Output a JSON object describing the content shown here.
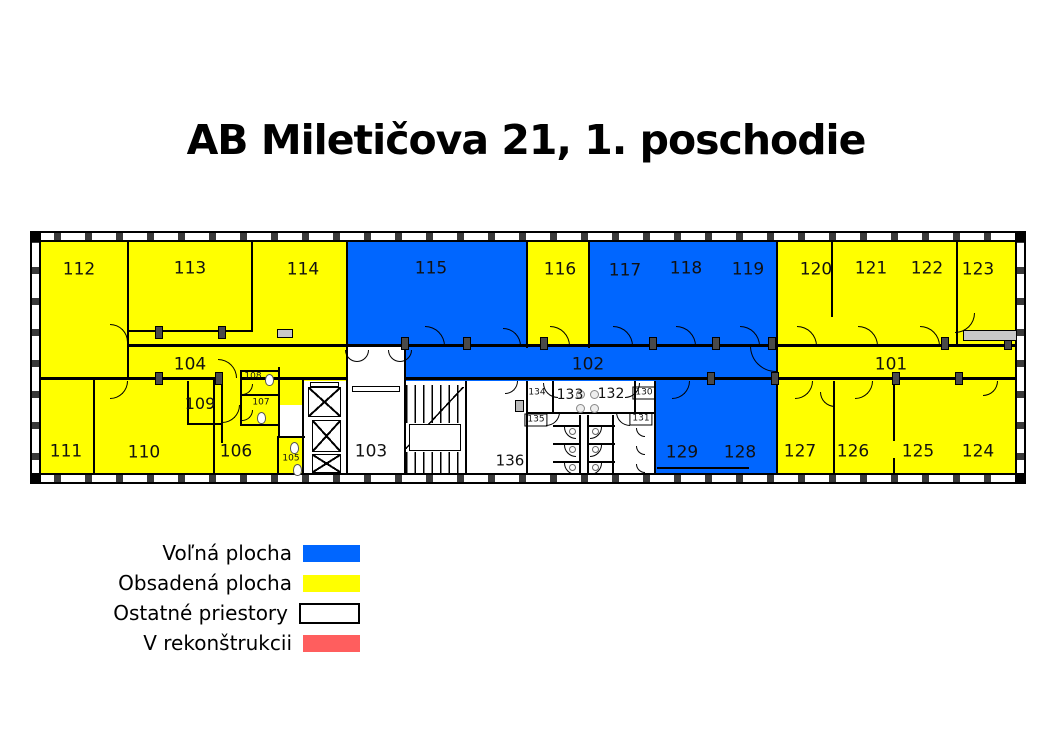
{
  "title": "AB Miletičova 21, 1. poschodie",
  "colors": {
    "free": "#0066FF",
    "occupied": "#FFFF00",
    "other": "#FFFFFF",
    "reconstruction": "#FF5E5E",
    "wall": "#000000",
    "text": "#111111"
  },
  "legend": {
    "items": [
      {
        "label": "Voľná plocha",
        "key": "free"
      },
      {
        "label": "Obsadená plocha",
        "key": "occupied"
      },
      {
        "label": "Ostatné priestory",
        "key": "other"
      },
      {
        "label": "V rekonštrukcii",
        "key": "reconstruction"
      }
    ]
  },
  "plan": {
    "outer": {
      "x": 30,
      "y": 231,
      "w": 996,
      "h": 253,
      "t": 11
    },
    "regions": [
      {
        "name": "block-left-occupied",
        "fill": "occupied",
        "x": 41,
        "y": 242,
        "w": 307,
        "h": 231
      },
      {
        "name": "room-115",
        "fill": "free",
        "x": 348,
        "y": 242,
        "w": 179,
        "h": 104
      },
      {
        "name": "room-116",
        "fill": "occupied",
        "x": 527,
        "y": 242,
        "w": 63,
        "h": 104
      },
      {
        "name": "rooms-117-119",
        "fill": "free",
        "x": 590,
        "y": 242,
        "w": 187,
        "h": 104
      },
      {
        "name": "rooms-120-123",
        "fill": "occupied",
        "x": 777,
        "y": 242,
        "w": 238,
        "h": 104
      },
      {
        "name": "corridor-102",
        "fill": "free",
        "x": 405,
        "y": 346,
        "w": 372,
        "h": 35
      },
      {
        "name": "corridor-101",
        "fill": "occupied",
        "x": 777,
        "y": 346,
        "w": 238,
        "h": 35
      },
      {
        "name": "lobby-103",
        "fill": "other",
        "x": 348,
        "y": 346,
        "w": 57,
        "h": 127
      },
      {
        "name": "elevator-area",
        "fill": "other",
        "x": 303,
        "y": 381,
        "w": 45,
        "h": 92
      },
      {
        "name": "vestibule-105",
        "fill": "other",
        "x": 278,
        "y": 405,
        "w": 25,
        "h": 31
      },
      {
        "name": "stairs-area",
        "fill": "other",
        "x": 405,
        "y": 381,
        "w": 61,
        "h": 92
      },
      {
        "name": "room-136",
        "fill": "other",
        "x": 466,
        "y": 381,
        "w": 61,
        "h": 92
      },
      {
        "name": "toilet-block",
        "fill": "other",
        "x": 527,
        "y": 381,
        "w": 128,
        "h": 92
      },
      {
        "name": "rooms-128-129",
        "fill": "free",
        "x": 655,
        "y": 381,
        "w": 122,
        "h": 92
      },
      {
        "name": "rooms-124-127",
        "fill": "occupied",
        "x": 777,
        "y": 381,
        "w": 238,
        "h": 92
      }
    ],
    "walls": [
      [
        127,
        242,
        2,
        137
      ],
      [
        251,
        242,
        2,
        90
      ],
      [
        127,
        330,
        126,
        2
      ],
      [
        346,
        242,
        2,
        106
      ],
      [
        526,
        242,
        2,
        106
      ],
      [
        588,
        242,
        2,
        106
      ],
      [
        776,
        242,
        2,
        141
      ],
      [
        831,
        242,
        2,
        75
      ],
      [
        956,
        242,
        2,
        104
      ],
      [
        127,
        344,
        889,
        2.5
      ],
      [
        41,
        377,
        182,
        2.5
      ],
      [
        240,
        377,
        108,
        2.5
      ],
      [
        405,
        377,
        611,
        2.5
      ],
      [
        93,
        379,
        2,
        94
      ],
      [
        213,
        379,
        2,
        94
      ],
      [
        302,
        379,
        2,
        94
      ],
      [
        346,
        346,
        2,
        127
      ],
      [
        404,
        346,
        2,
        127
      ],
      [
        465,
        381,
        2,
        92
      ],
      [
        526,
        381,
        2,
        92
      ],
      [
        654,
        381,
        2,
        92
      ],
      [
        776,
        381,
        2,
        92
      ],
      [
        833,
        381,
        2,
        92
      ],
      [
        893,
        381,
        2,
        60
      ],
      [
        893,
        458,
        2,
        15
      ],
      [
        187,
        381,
        2,
        43
      ],
      [
        221,
        381,
        2,
        62
      ],
      [
        187,
        423,
        36,
        2
      ],
      [
        240,
        370,
        40,
        2
      ],
      [
        240,
        370,
        2,
        56
      ],
      [
        278,
        367,
        2,
        70
      ],
      [
        240,
        394,
        40,
        2
      ],
      [
        240,
        424,
        40,
        2
      ],
      [
        278,
        436,
        27,
        2
      ],
      [
        277,
        436,
        2,
        37
      ],
      [
        552,
        381,
        2,
        32
      ],
      [
        634,
        381,
        2,
        32
      ],
      [
        527,
        412,
        128,
        2
      ],
      [
        579,
        415,
        2,
        58
      ],
      [
        587,
        415,
        2,
        58
      ],
      [
        612,
        415,
        2,
        58
      ],
      [
        553,
        425,
        27,
        1.5
      ],
      [
        553,
        443,
        27,
        1.5
      ],
      [
        553,
        461,
        27,
        1.5
      ],
      [
        588,
        425,
        27,
        1.5
      ],
      [
        588,
        443,
        27,
        1.5
      ],
      [
        588,
        461,
        27,
        1.5
      ],
      [
        657,
        467,
        92,
        1.5
      ]
    ],
    "labels": [
      {
        "t": "112",
        "x": 79,
        "y": 270
      },
      {
        "t": "113",
        "x": 190,
        "y": 269
      },
      {
        "t": "114",
        "x": 303,
        "y": 270
      },
      {
        "t": "115",
        "x": 431,
        "y": 269
      },
      {
        "t": "116",
        "x": 560,
        "y": 270
      },
      {
        "t": "117",
        "x": 625,
        "y": 271
      },
      {
        "t": "118",
        "x": 686,
        "y": 269
      },
      {
        "t": "119",
        "x": 748,
        "y": 270
      },
      {
        "t": "120",
        "x": 816,
        "y": 270
      },
      {
        "t": "121",
        "x": 871,
        "y": 269
      },
      {
        "t": "122",
        "x": 927,
        "y": 269
      },
      {
        "t": "123",
        "x": 978,
        "y": 270
      },
      {
        "t": "104",
        "x": 190,
        "y": 365
      },
      {
        "t": "102",
        "x": 588,
        "y": 365
      },
      {
        "t": "101",
        "x": 891,
        "y": 365
      },
      {
        "t": "111",
        "x": 66,
        "y": 452
      },
      {
        "t": "110",
        "x": 144,
        "y": 453
      },
      {
        "t": "106",
        "x": 236,
        "y": 452
      },
      {
        "t": "109",
        "x": 200,
        "y": 404,
        "s": 16
      },
      {
        "t": "103",
        "x": 371,
        "y": 452
      },
      {
        "t": "136",
        "x": 510,
        "y": 461,
        "s": 15
      },
      {
        "t": "133",
        "x": 570,
        "y": 395,
        "s": 14
      },
      {
        "t": "132",
        "x": 611,
        "y": 394,
        "s": 14
      },
      {
        "t": "129",
        "x": 682,
        "y": 453
      },
      {
        "t": "128",
        "x": 740,
        "y": 453
      },
      {
        "t": "127",
        "x": 800,
        "y": 452
      },
      {
        "t": "126",
        "x": 853,
        "y": 452
      },
      {
        "t": "125",
        "x": 918,
        "y": 452
      },
      {
        "t": "124",
        "x": 978,
        "y": 452
      },
      {
        "t": "108",
        "x": 253,
        "y": 377,
        "s": 9
      },
      {
        "t": "107",
        "x": 261,
        "y": 403,
        "s": 9
      },
      {
        "t": "105",
        "x": 291,
        "y": 459,
        "s": 9
      },
      {
        "t": "134",
        "x": 537,
        "y": 393,
        "s": 9
      },
      {
        "t": "130",
        "x": 644,
        "y": 393,
        "s": 9,
        "b": true
      },
      {
        "t": "135",
        "x": 536,
        "y": 420,
        "s": 9,
        "b": true
      },
      {
        "t": "131",
        "x": 641,
        "y": 419,
        "s": 9,
        "b": true
      }
    ],
    "doors": [
      [
        110,
        324,
        18,
        "bl"
      ],
      [
        110,
        381,
        18,
        "tl"
      ],
      [
        218,
        359,
        19,
        "bl"
      ],
      [
        222,
        405,
        18,
        "tl"
      ],
      [
        242,
        384,
        11,
        "tl"
      ],
      [
        242,
        410,
        11,
        "tl"
      ],
      [
        345,
        350,
        12,
        "tr"
      ],
      [
        357,
        350,
        12,
        "tl"
      ],
      [
        388,
        350,
        12,
        "tr"
      ],
      [
        400,
        350,
        12,
        "tl"
      ],
      [
        425,
        326,
        20,
        "bl"
      ],
      [
        503,
        328,
        18,
        "bl"
      ],
      [
        550,
        326,
        20,
        "bl"
      ],
      [
        613,
        326,
        20,
        "bl"
      ],
      [
        676,
        326,
        20,
        "bl"
      ],
      [
        740,
        326,
        20,
        "bl"
      ],
      [
        797,
        326,
        20,
        "bl"
      ],
      [
        858,
        326,
        20,
        "bl"
      ],
      [
        920,
        326,
        20,
        "bl"
      ],
      [
        955,
        313,
        20,
        "tl"
      ],
      [
        750,
        346,
        26,
        "tr"
      ],
      [
        672,
        381,
        18,
        "tl"
      ],
      [
        795,
        381,
        18,
        "tl"
      ],
      [
        820,
        392,
        15,
        "tr"
      ],
      [
        855,
        381,
        18,
        "tl"
      ],
      [
        983,
        381,
        15,
        "tl"
      ],
      [
        505,
        381,
        13,
        "tl"
      ],
      [
        543,
        383,
        15,
        "tr"
      ],
      [
        625,
        383,
        15,
        "tl"
      ],
      [
        546,
        412,
        14,
        "tl"
      ],
      [
        616,
        412,
        14,
        "tr"
      ],
      [
        564,
        427,
        12,
        "tr"
      ],
      [
        564,
        445,
        12,
        "tr"
      ],
      [
        564,
        463,
        12,
        "tr"
      ],
      [
        590,
        427,
        12,
        "tl"
      ],
      [
        590,
        445,
        12,
        "tl"
      ],
      [
        590,
        463,
        12,
        "tl"
      ],
      [
        636,
        428,
        9,
        "tr"
      ],
      [
        636,
        446,
        9,
        "tr"
      ],
      [
        636,
        464,
        9,
        "tr"
      ]
    ],
    "posts": [
      [
        155,
        326
      ],
      [
        218,
        326
      ],
      [
        401,
        337
      ],
      [
        463,
        337
      ],
      [
        540,
        337
      ],
      [
        649,
        337
      ],
      [
        712,
        337
      ],
      [
        768,
        337
      ],
      [
        941,
        337
      ],
      [
        1004,
        337
      ],
      [
        155,
        372
      ],
      [
        215,
        372
      ],
      [
        707,
        372
      ],
      [
        771,
        372
      ],
      [
        892,
        372
      ],
      [
        955,
        372
      ]
    ],
    "radiators": [
      [
        963,
        330,
        54,
        11
      ],
      [
        277,
        329,
        16,
        9
      ]
    ],
    "elevators": [
      [
        308,
        387,
        33,
        30
      ],
      [
        312,
        420,
        29,
        32
      ],
      [
        312,
        454,
        29,
        19
      ]
    ],
    "vent": [
      310,
      382,
      29,
      5
    ],
    "mat": [
      352,
      386,
      48,
      6
    ],
    "shaft_box": [
      515,
      400,
      9,
      12
    ],
    "stairs": {
      "flights": [
        [
          406,
          385,
          58,
          38
        ],
        [
          406,
          452,
          58,
          21
        ]
      ],
      "landing": [
        409,
        424,
        52,
        27
      ],
      "diag": [
        406,
        387,
        58,
        62
      ]
    },
    "fixtures": {
      "wc": [
        [
          265,
          374
        ],
        [
          257,
          412
        ],
        [
          293,
          464
        ],
        [
          290,
          442
        ]
      ],
      "sinks": [
        [
          576,
          390
        ],
        [
          590,
          390
        ],
        [
          576,
          404
        ],
        [
          590,
          404
        ]
      ],
      "stall_wc": [
        [
          569,
          428
        ],
        [
          592,
          428
        ],
        [
          569,
          446
        ],
        [
          592,
          446
        ],
        [
          569,
          464
        ],
        [
          592,
          464
        ]
      ]
    }
  }
}
